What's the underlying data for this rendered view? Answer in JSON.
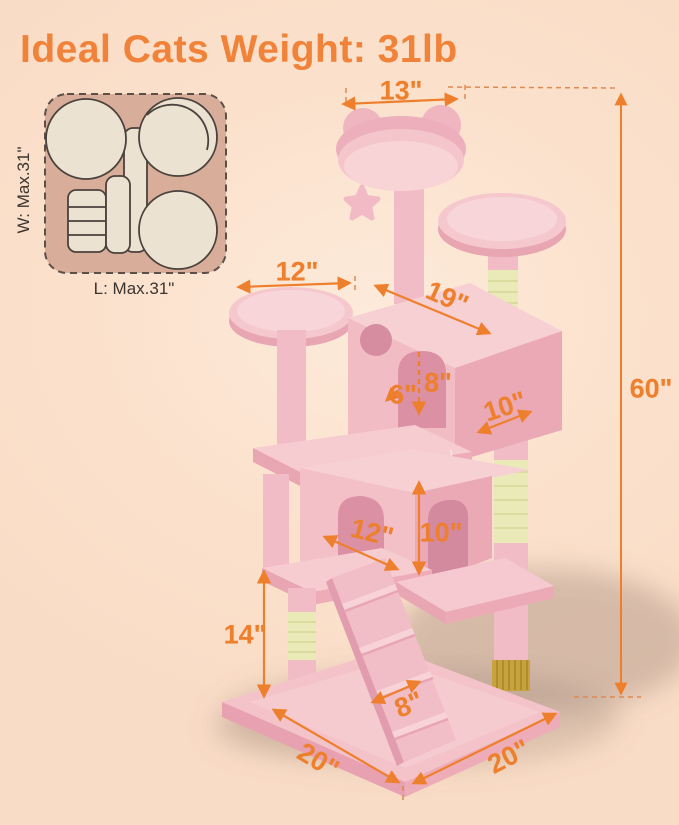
{
  "title": "Ideal Cats Weight: 31lb",
  "top_view_inset": {
    "width_label": "W: Max.31\"",
    "length_label": "L: Max.31\""
  },
  "dimension_labels": {
    "top_perch_width": "13\"",
    "left_platform_width": "12\"",
    "condo_top_depth": "19\"",
    "condo_door_width": "6\"",
    "condo_door_height": "8\"",
    "condo_right_width": "10\"",
    "house_front_width": "12\"",
    "house_height": "10\"",
    "lower_section_height": "14\"",
    "ramp_width": "8\"",
    "base_left_depth": "20\"",
    "base_right_width": "20\"",
    "total_height": "60\""
  },
  "colors": {
    "accent_orange": "#ee7f2c",
    "title_orange": "#f0823a",
    "tree_pink": "#f3c1c8",
    "tree_pink_light": "#f8d5d8",
    "tree_pink_shade": "#eba9b6",
    "sisal_green": "#e9eab8",
    "sisal_gold": "#c7a23e",
    "inset_tan": "#d8ae9a",
    "inset_cream": "#ece2d2",
    "background_peach": "#fbdfca"
  }
}
